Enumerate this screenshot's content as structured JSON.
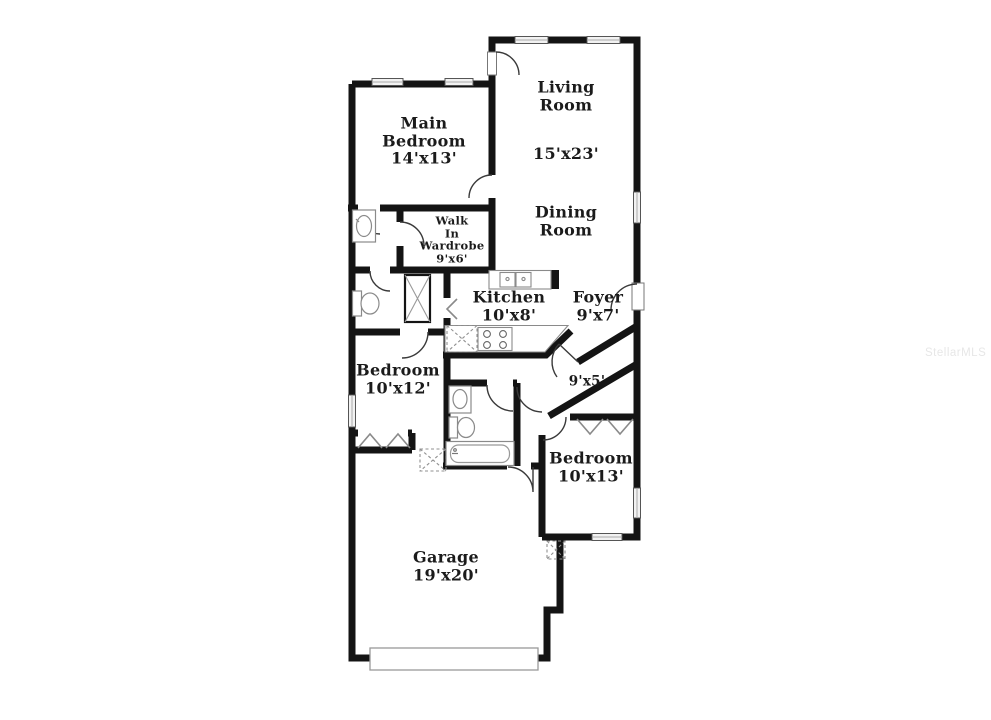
{
  "watermark": {
    "text": "StellarMLS"
  },
  "colors": {
    "walls": "#141414",
    "fixtures": "#8a8a8a",
    "window_fill": "#f2f2f2",
    "door_arc": "#3a3a3a",
    "label_text": "#1b1b1b",
    "watermark_text": "#e7e7e7"
  },
  "labels": [
    {
      "id": "main-bedroom",
      "text": "Main\nBedroom\n14'x13'",
      "x": 424,
      "y": 141,
      "size": 16
    },
    {
      "id": "living-room",
      "text": "Living\nRoom",
      "x": 566,
      "y": 96,
      "size": 16
    },
    {
      "id": "living-room-dims",
      "text": "15'x23'",
      "x": 566,
      "y": 154,
      "size": 16
    },
    {
      "id": "dining-room",
      "text": "Dining\nRoom",
      "x": 566,
      "y": 221,
      "size": 16
    },
    {
      "id": "walk-in-wardrobe",
      "text": "Walk\nIn\nWardrobe\n9'x6'",
      "x": 452,
      "y": 240,
      "size": 11.5
    },
    {
      "id": "kitchen",
      "text": "Kitchen\n10'x8'",
      "x": 509,
      "y": 306,
      "size": 16
    },
    {
      "id": "foyer",
      "text": "Foyer\n9'x7'",
      "x": 598,
      "y": 306,
      "size": 16
    },
    {
      "id": "bedroom-10x12",
      "text": "Bedroom\n10'x12'",
      "x": 398,
      "y": 379,
      "size": 16
    },
    {
      "id": "hall-9x5",
      "text": "9'x5'",
      "x": 587,
      "y": 382,
      "size": 13.5
    },
    {
      "id": "bedroom-10x13",
      "text": "Bedroom\n10'x13'",
      "x": 591,
      "y": 467,
      "size": 16
    },
    {
      "id": "garage",
      "text": "Garage\n19'x20'",
      "x": 446,
      "y": 566,
      "size": 16
    }
  ]
}
